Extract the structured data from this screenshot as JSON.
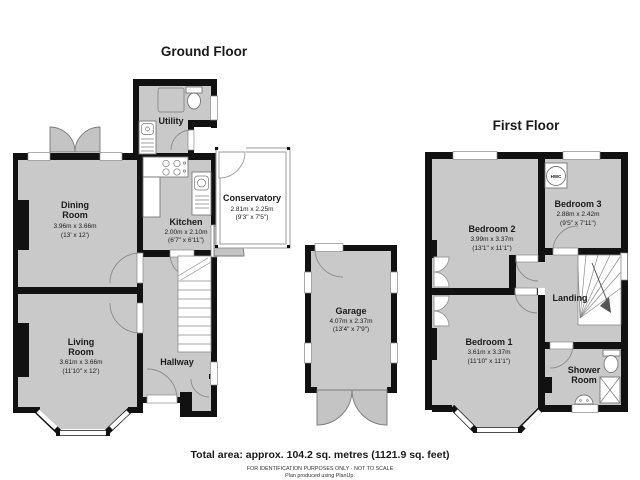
{
  "titles": {
    "ground": "Ground Floor",
    "first": "First Floor"
  },
  "footer": {
    "total_area": "Total area: approx. 104.2 sq. metres (1121.9 sq. feet)",
    "disclaimer": "FOR IDENTIFICATION PURPOSES ONLY - NOT TO SCALE",
    "credit": "Plan produced using PlanUp."
  },
  "colors": {
    "floor_fill": "#c9c9c9",
    "wall": "#111111",
    "outline": "#8a8a8a"
  },
  "rooms": {
    "dining": {
      "name1": "Dining",
      "name2": "Room",
      "metric": "3.96m x 3.66m",
      "imperial": "(13' x 12')"
    },
    "kitchen": {
      "name1": "Kitchen",
      "metric": "2.00m x 2.10m",
      "imperial": "(6'7\" x 6'11\")"
    },
    "utility": {
      "name1": "Utility"
    },
    "conservatory": {
      "name1": "Conservatory",
      "metric": "2.81m x 2.25m",
      "imperial": "(9'3\" x 7'5\")"
    },
    "living": {
      "name1": "Living",
      "name2": "Room",
      "metric": "3.61m x 3.66m",
      "imperial": "(11'10\" x 12')"
    },
    "hallway": {
      "name1": "Hallway"
    },
    "garage": {
      "name1": "Garage",
      "metric": "4.07m x 2.37m",
      "imperial": "(13'4\" x 7'9\")"
    },
    "bedroom1": {
      "name1": "Bedroom 1",
      "metric": "3.61m x 3.37m",
      "imperial": "(11'10\" x 11'1\")"
    },
    "bedroom2": {
      "name1": "Bedroom 2",
      "metric": "3.99m x 3.37m",
      "imperial": "(13'1\" x 11'1\")"
    },
    "bedroom3": {
      "name1": "Bedroom 3",
      "metric": "2.88m x 2.42m",
      "imperial": "(9'5\" x 7'11\")"
    },
    "landing": {
      "name1": "Landing"
    },
    "shower": {
      "name1": "Shower",
      "name2": "Room"
    },
    "hwc": {
      "label": "HWC"
    }
  }
}
